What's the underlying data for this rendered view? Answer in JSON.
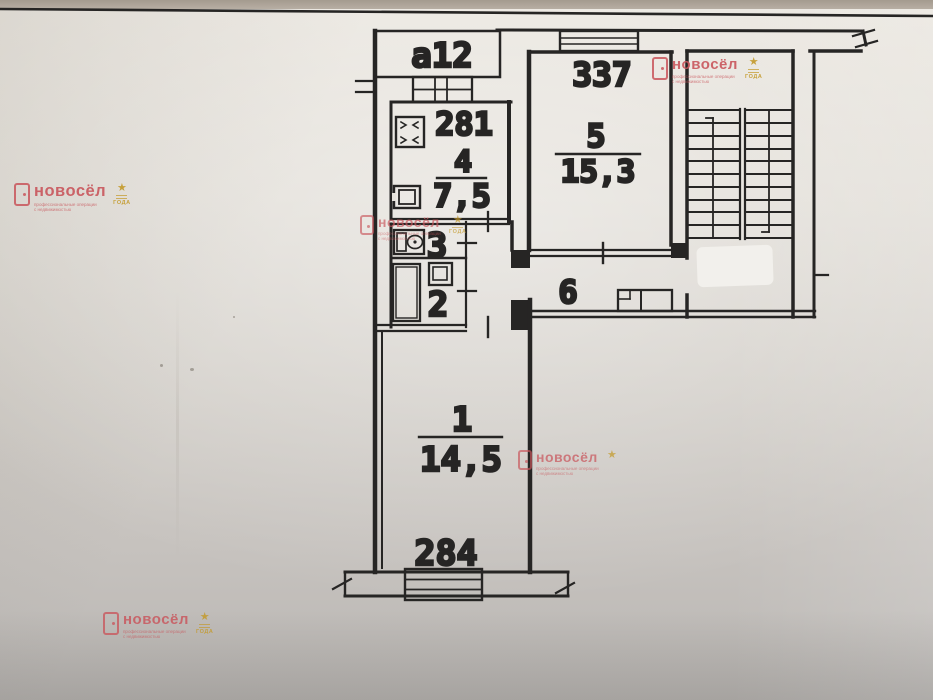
{
  "plan": {
    "balcony_label": "a12",
    "stamps": {
      "kitchen": "281",
      "living": "337",
      "room1": "284"
    },
    "rooms": {
      "kitchen": {
        "number": "4",
        "area": "7,5"
      },
      "living": {
        "number": "5",
        "area": "15,3"
      },
      "toilet": {
        "number": "3"
      },
      "bathroom": {
        "number": "2"
      },
      "hallway": {
        "number": "6"
      },
      "room1": {
        "number": "1",
        "area": "14,5"
      }
    }
  },
  "watermark": {
    "brand": "новосёл",
    "tagline": "профессиональные операции с недвижимостью",
    "award": "ГОДА",
    "star": "★",
    "brand_color": "#c9565c",
    "award_color": "#c49a2a"
  }
}
